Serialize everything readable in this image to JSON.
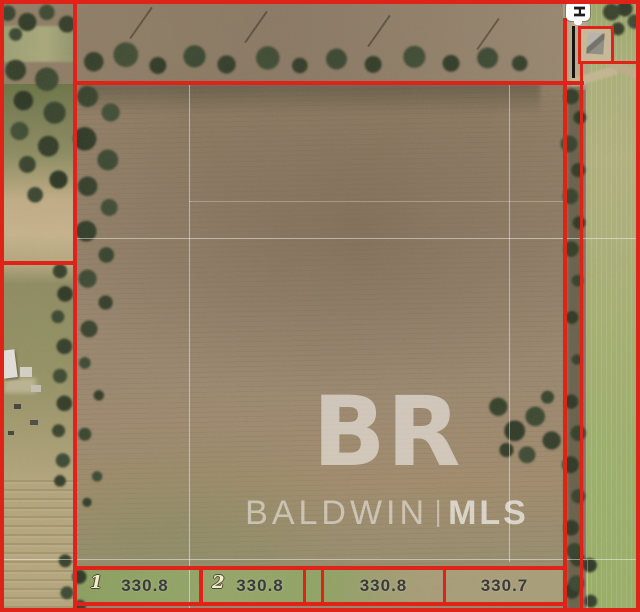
{
  "map": {
    "watermark": {
      "logo": "BR",
      "brand_left": "BALDWIN",
      "separator": "|",
      "brand_right": "MLS"
    },
    "road_marker": {
      "glyph": "H"
    },
    "lots": [
      {
        "label": "1",
        "frontage": "330.8"
      },
      {
        "label": "2",
        "frontage": "330.8"
      },
      {
        "label": "",
        "frontage": "330.8"
      },
      {
        "label": "",
        "frontage": "330.7"
      }
    ],
    "colors": {
      "boundary_red": "#e02318",
      "survey_gridline": "rgba(255,255,255,0.45)",
      "watermark_white": "rgba(255,255,255,0.55)"
    }
  }
}
